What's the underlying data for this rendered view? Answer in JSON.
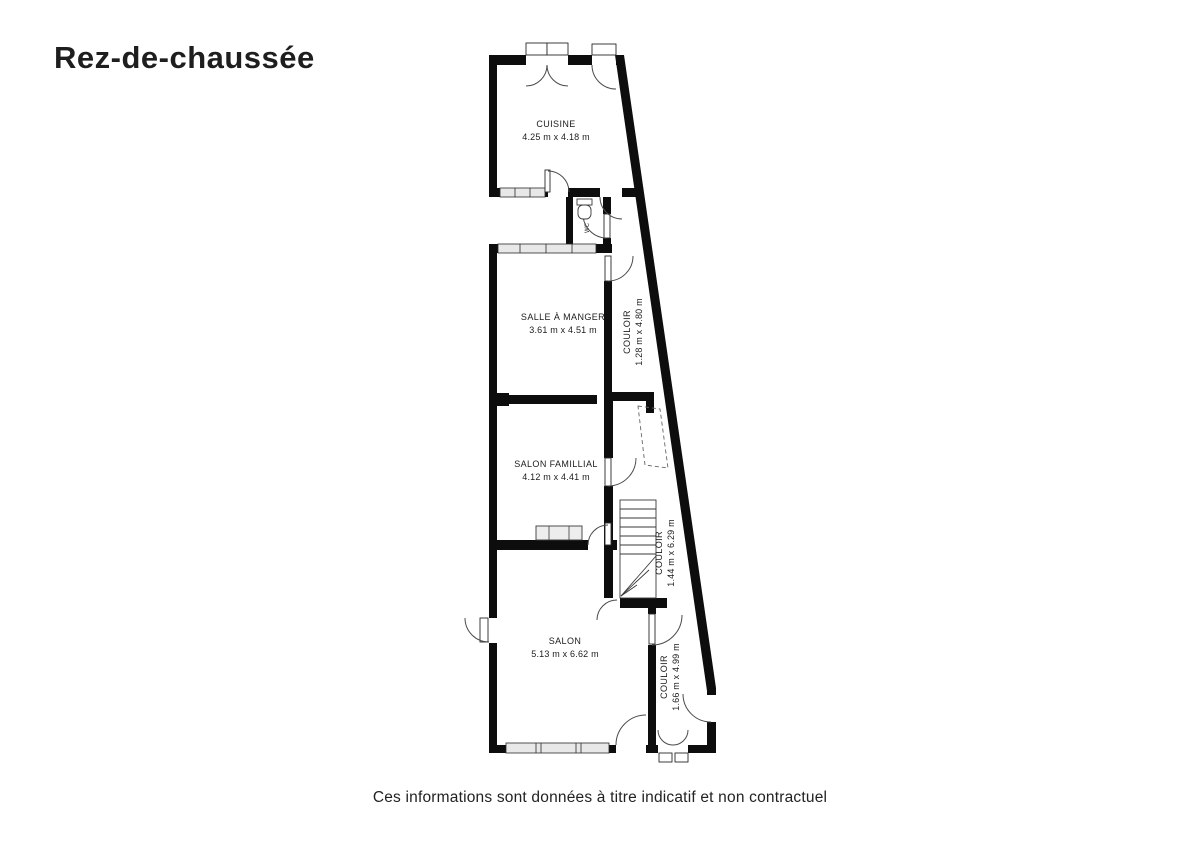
{
  "page": {
    "title": "Rez-de-chaussée",
    "footer_disclaimer": "Ces informations sont données à titre indicatif et non contractuel",
    "background_color": "#ffffff",
    "wall_color": "#0d0d0d",
    "window_fill": "#e8e8e8"
  },
  "floor_plan": {
    "rooms": [
      {
        "id": "cuisine",
        "label": "CUISINE",
        "dimensions": "4.25 m x 4.18 m",
        "orientation": "horizontal"
      },
      {
        "id": "salle_a_manger",
        "label": "SALLE À MANGER",
        "dimensions": "3.61 m x 4.51 m",
        "orientation": "horizontal"
      },
      {
        "id": "couloir_1",
        "label": "COULOIR",
        "dimensions": "1.28 m x 4.80 m",
        "orientation": "vertical"
      },
      {
        "id": "salon_familial",
        "label": "SALON FAMILLIAL",
        "dimensions": "4.12 m x 4.41 m",
        "orientation": "horizontal"
      },
      {
        "id": "couloir_2",
        "label": "COULOIR",
        "dimensions": "1.44 m x 6.29 m",
        "orientation": "vertical"
      },
      {
        "id": "salon",
        "label": "SALON",
        "dimensions": "5.13 m x 6.62 m",
        "orientation": "horizontal"
      },
      {
        "id": "couloir_3",
        "label": "COULOIR",
        "dimensions": "1.66 m x 4.99 m",
        "orientation": "vertical"
      },
      {
        "id": "wc",
        "label": "WC",
        "dimensions": "",
        "orientation": "vertical"
      }
    ]
  }
}
